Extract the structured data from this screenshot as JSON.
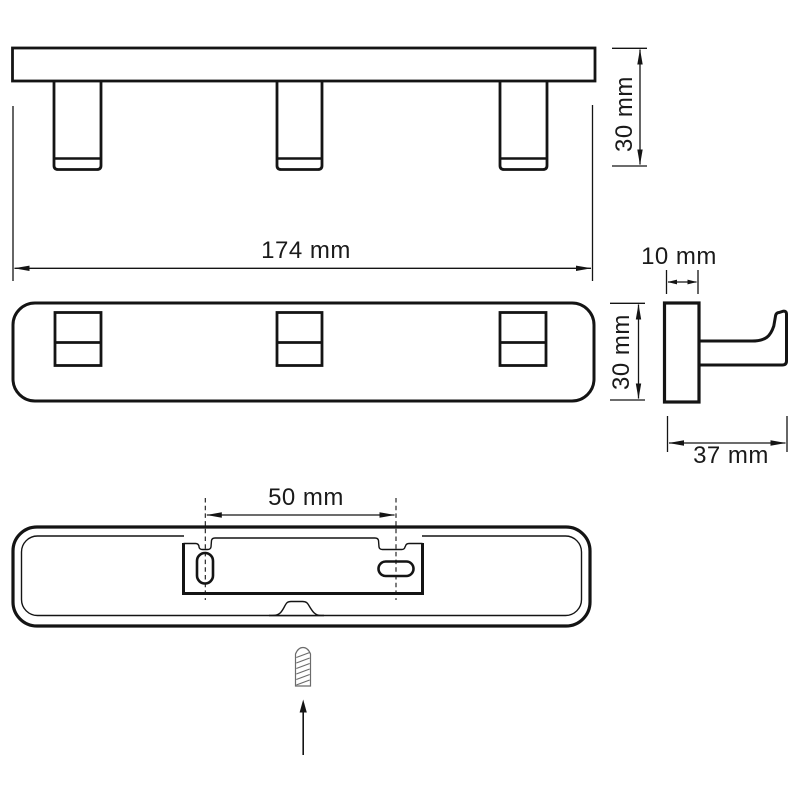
{
  "colors": {
    "line": "#141414",
    "screw": "#6b6b6b",
    "background": "#ffffff"
  },
  "views": {
    "front": {
      "width_label": "174 mm",
      "height_label": "30 mm"
    },
    "plan": {
      "height_label": "30 mm"
    },
    "side": {
      "width_label": "10 mm",
      "depth_label": "37 mm"
    },
    "back": {
      "hole_spacing_label": "50 mm"
    }
  }
}
